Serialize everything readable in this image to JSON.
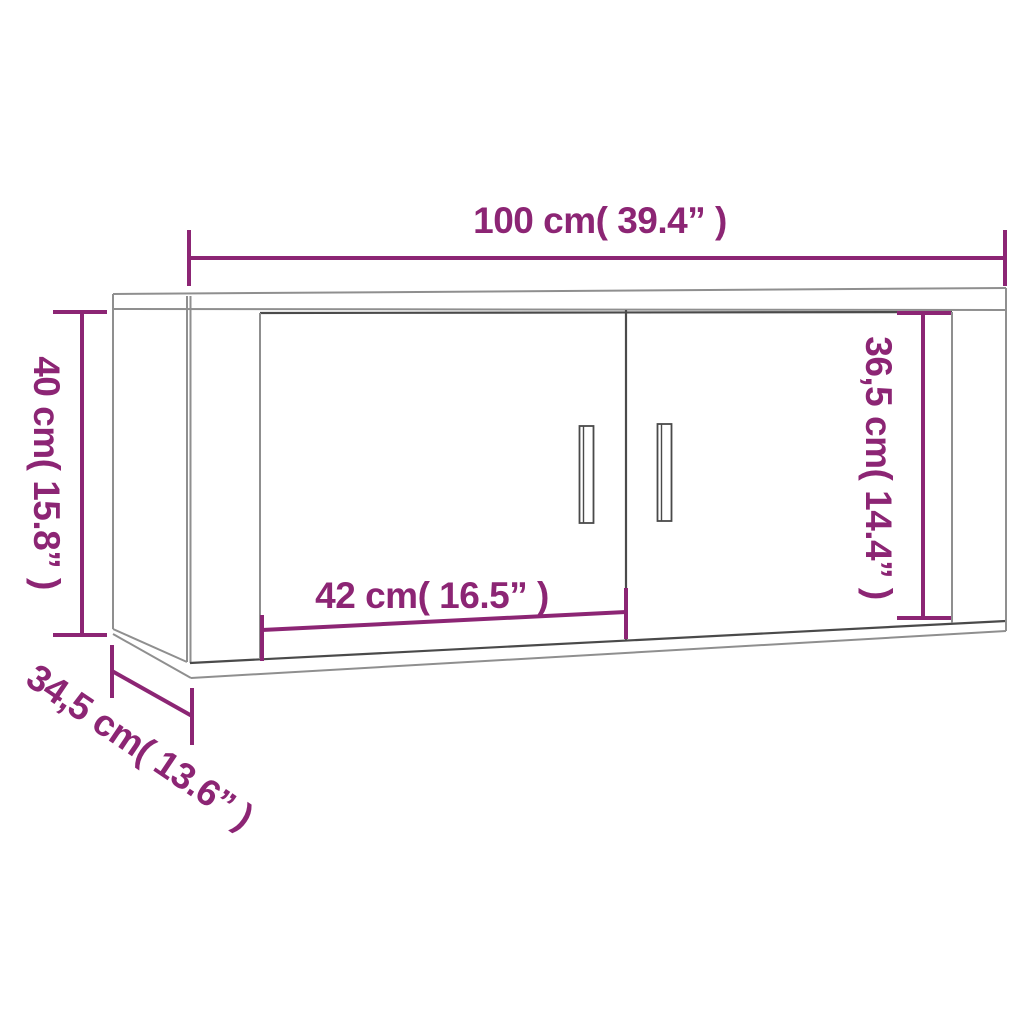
{
  "colors": {
    "accent": "#8c2574",
    "line_light": "#8f8f8f",
    "line_dark": "#4a4a4a",
    "background": "#ffffff"
  },
  "dimensions": {
    "width": "100 cm( 39.4” )",
    "height": "40 cm( 15.8” )",
    "door_height": "36,5 cm( 14.4” )",
    "door_width": "42 cm( 16.5” )",
    "depth": "34,5 cm( 13.6” )"
  }
}
